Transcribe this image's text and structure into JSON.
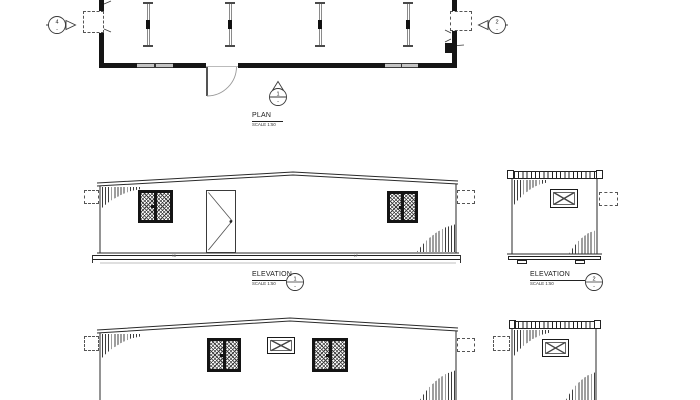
{
  "palette": {
    "background": "#ffffff",
    "ink": "#1c1c1c",
    "hatch_gray": "#8a8a8a"
  },
  "plan": {
    "title": "PLAN",
    "scale_label": "SCALE 1:50",
    "marker_left": {
      "number": "4",
      "dash": "-"
    },
    "marker_right": {
      "number": "2",
      "dash": "-"
    },
    "marker_front": {
      "number": "1",
      "dash": "-"
    }
  },
  "elevation_front": {
    "title": "ELEVATION",
    "scale_label": "SCALE 1:50",
    "marker": {
      "number": "1",
      "dash": "-"
    },
    "base_mark_left": "9B",
    "base_mark_right": "LF"
  },
  "elevation_side": {
    "title": "ELEVATION",
    "scale_label": "SCALE 1:50",
    "marker": {
      "number": "2",
      "dash": "-"
    }
  }
}
